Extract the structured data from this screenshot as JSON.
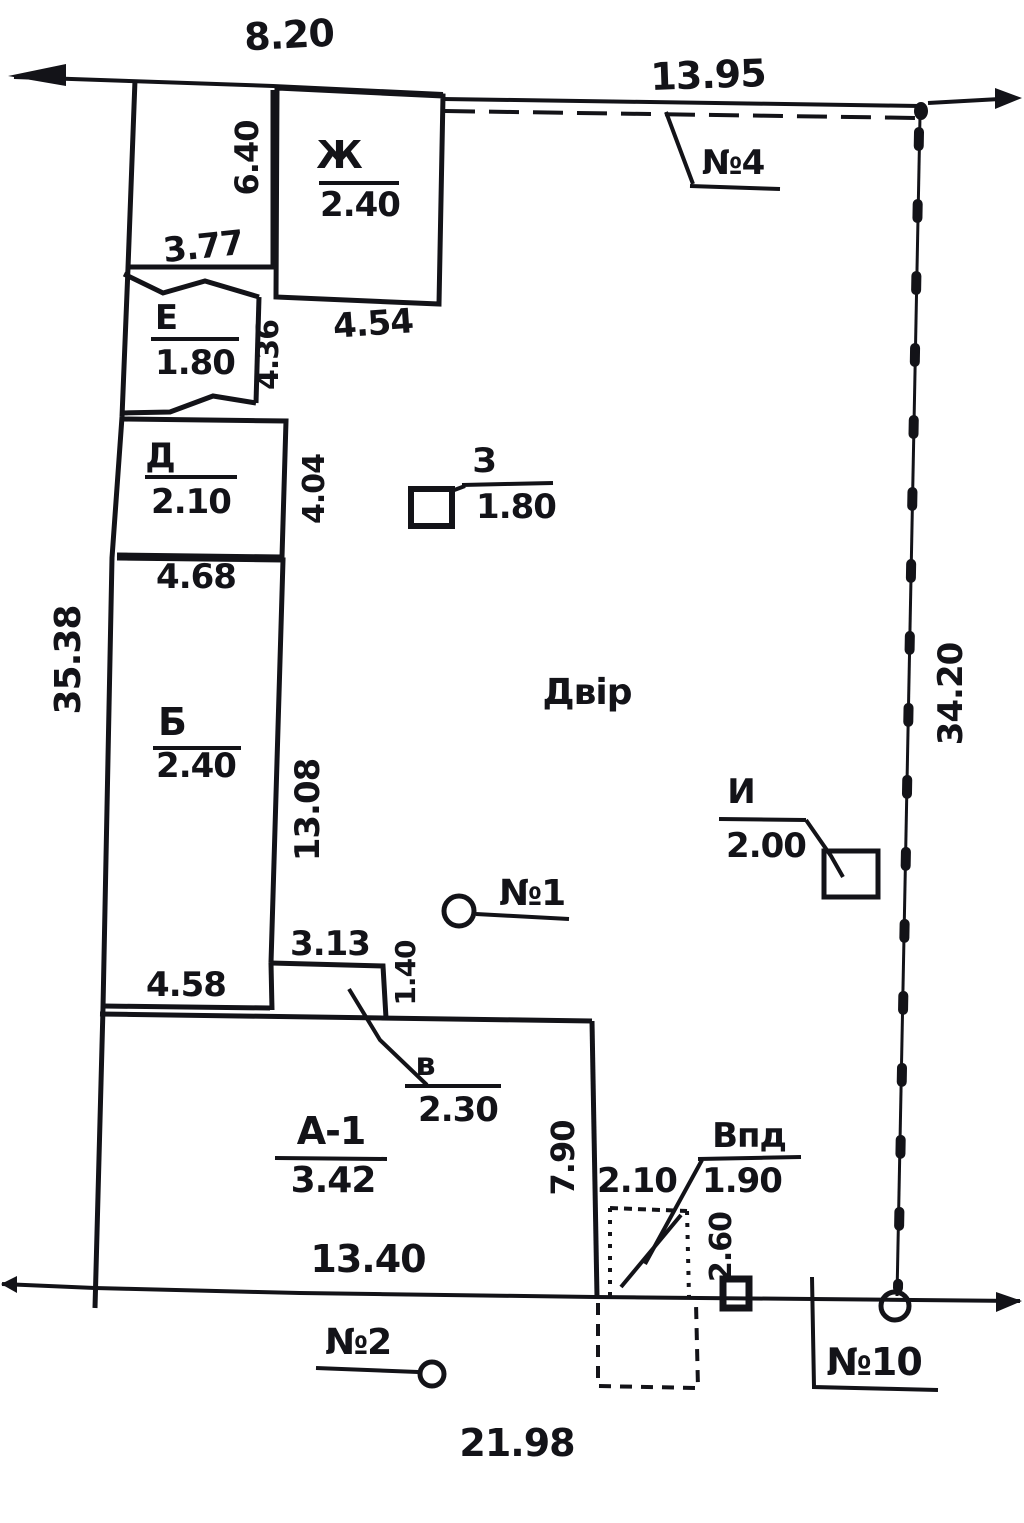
{
  "plan": {
    "yard_label": "Двір",
    "dimensions": {
      "top_width": "8.20",
      "top_fence_width": "13.95",
      "left_side": "35.38",
      "right_side": "34.20",
      "bottom_total": "21.98",
      "enclosure_height": "6.40",
      "enclosure_bottom": "3.77",
      "zh_bottom": "4.54",
      "e_right": "4.36",
      "d_right": "4.04",
      "d_bottom": "4.68",
      "b_right": "13.08",
      "b_bottom": "4.58",
      "porch_width": "3.13",
      "porch_height": "1.40",
      "house_bottom": "13.40",
      "house_right": "7.90",
      "vpd_width": "2.10",
      "vpd_height": "2.60"
    },
    "structures": {
      "zh": {
        "letter": "Ж",
        "value": "2.40"
      },
      "e": {
        "letter": "Е",
        "value": "1.80"
      },
      "d": {
        "letter": "Д",
        "value": "2.10"
      },
      "b": {
        "letter": "Б",
        "value": "2.40"
      },
      "a1": {
        "letter": "А-1",
        "value": "3.42"
      },
      "z": {
        "letter": "З",
        "value": "1.80"
      },
      "i": {
        "letter": "И",
        "value": "2.00"
      },
      "v": {
        "letter": "в",
        "value": "2.30"
      },
      "vpd": {
        "letter": "Впд",
        "value": "1.90"
      }
    },
    "point_markers": {
      "n1": "№1",
      "n2": "№2",
      "n4": "№4",
      "n10": "№10"
    }
  }
}
